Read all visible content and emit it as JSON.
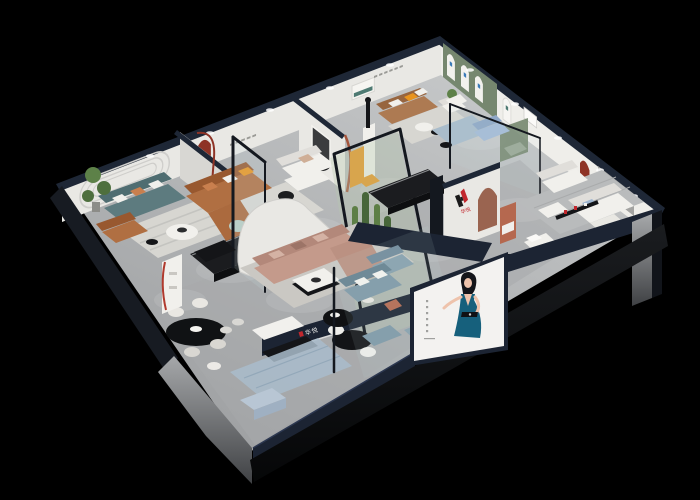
{
  "meta": {
    "title": "Isometric 3D cutaway render of a furniture brand showroom on a black background",
    "render_type": "3d-dollhouse-interior"
  },
  "brand": {
    "logo_letter": "H",
    "logo_text": "华悦",
    "fascia_text": "华悦"
  },
  "poster": {
    "subject": "fashion model in a teal evening dress on a white lightbox"
  },
  "scene": {
    "rooms": [
      "teal-sofa-lounge",
      "caramel-leather-living-room",
      "boucle-sofa-corner",
      "central-sectional-area",
      "cactus-terrarium",
      "brown-leather-gallery",
      "glass-blue-sofa-room",
      "white-sofa-showroom",
      "brand-logo-wall-bay",
      "steel-blue-sofa-showcase",
      "entry-dining-showcase"
    ]
  },
  "palette": {
    "bg": "#000000",
    "wallCap": "#1e2736",
    "wallA": "#e9e8e4",
    "wallB": "#efeeea",
    "wallShade": "#d8d7d3",
    "floorA": "#c6c8c9",
    "floorB": "#9fa1a3",
    "walkway": "#a7a9ab",
    "rugCream": "#d7d6d1",
    "rugBlue": "#a9bccb",
    "plinthA": "#1a1c1f",
    "plinthB": "#060708",
    "slab": "#171b22",
    "wedgeA": "#a6a8aa",
    "wedgeB": "#3f4144",
    "navy": "#1c2433",
    "glassTint": "#c7dde4",
    "frameDark": "#14181f",
    "tealSofa": "#5d7b7f",
    "tealSofaDark": "#4f6d71",
    "caramel": "#b06f42",
    "caramelDark": "#98582f",
    "brown": "#ad7a52",
    "brownDark": "#97653f",
    "tan": "#c49a8b",
    "tanDark": "#b3887a",
    "blueSofa": "#a4bad6",
    "blueSofaDark": "#8fa7c6",
    "steelBlue": "#7e98a6",
    "steelBlueDark": "#66808f",
    "sage": "#9aa896",
    "greenWall": "#76876f",
    "orange": "#e8941f",
    "pillowOrange": "#c97f4e",
    "redNiche": "#8e3326",
    "redAccent": "#b03a2e",
    "logoRed": "#c1272d",
    "blackFur": "#141518",
    "whiteFur": "#f1f0ec",
    "whiteFurDark": "#e0deda",
    "mint": "#b7ccc2",
    "plant": "#4e6f3e",
    "plantLight": "#5d8148",
    "cactus": "#5d7f46",
    "cactusDark": "#47663a",
    "posterBg": "#f3f2f0",
    "dress": "#16607c",
    "skin": "#eec3ac",
    "hair": "#14151a",
    "terracotta": "#b5684f",
    "counterBlue": "#b8c6d4",
    "tvGray": "#a3a3a1"
  }
}
